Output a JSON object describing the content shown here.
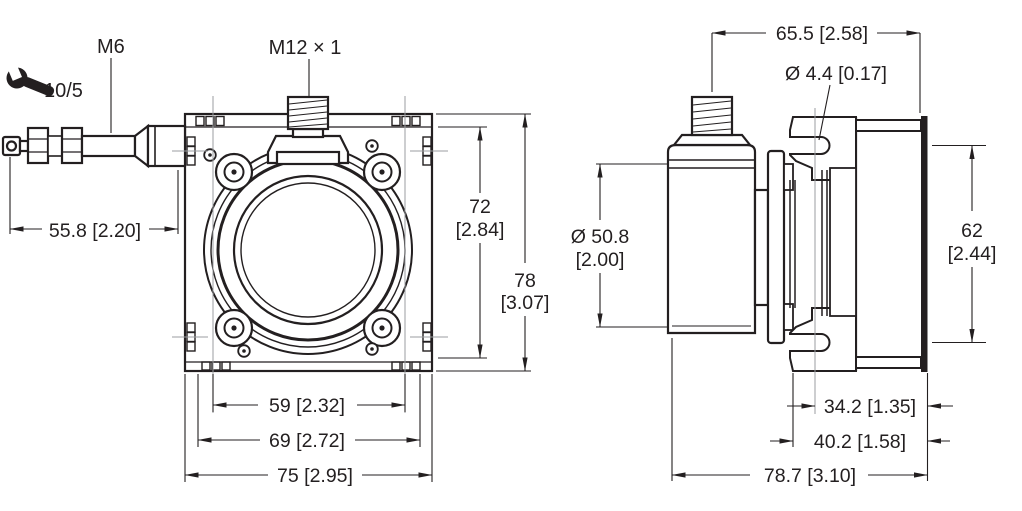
{
  "labels": {
    "wrench_size": "10/5",
    "rod_thread": "M6",
    "connector_thread": "M12 × 1",
    "mounting_hole": "Ø 4.4 [0.17]"
  },
  "front_view": {
    "dimensions": {
      "rod_length": "55.8 [2.20]",
      "mount_height_mm": "72",
      "mount_height_in": "[2.84]",
      "overall_height_mm": "78",
      "overall_height_in": "[3.07]",
      "slot_spacing": "59 [2.32]",
      "tab_width": "69 [2.72]",
      "overall_width": "75 [2.95]"
    }
  },
  "side_view": {
    "dimensions": {
      "connector_to_flange": "65.5 [2.58]",
      "body_diameter_mm": "Ø 50.8",
      "body_diameter_in": "[2.00]",
      "slot_distance_mm": "62",
      "slot_distance_in": "[2.44]",
      "slot_to_flange": "34.2 [1.35]",
      "bracket_to_flange": "40.2 [1.58]",
      "overall_depth": "78.7 [3.10]"
    }
  },
  "colors": {
    "line": "#231f20",
    "centerline": "#9b9da0",
    "background": "#ffffff"
  }
}
